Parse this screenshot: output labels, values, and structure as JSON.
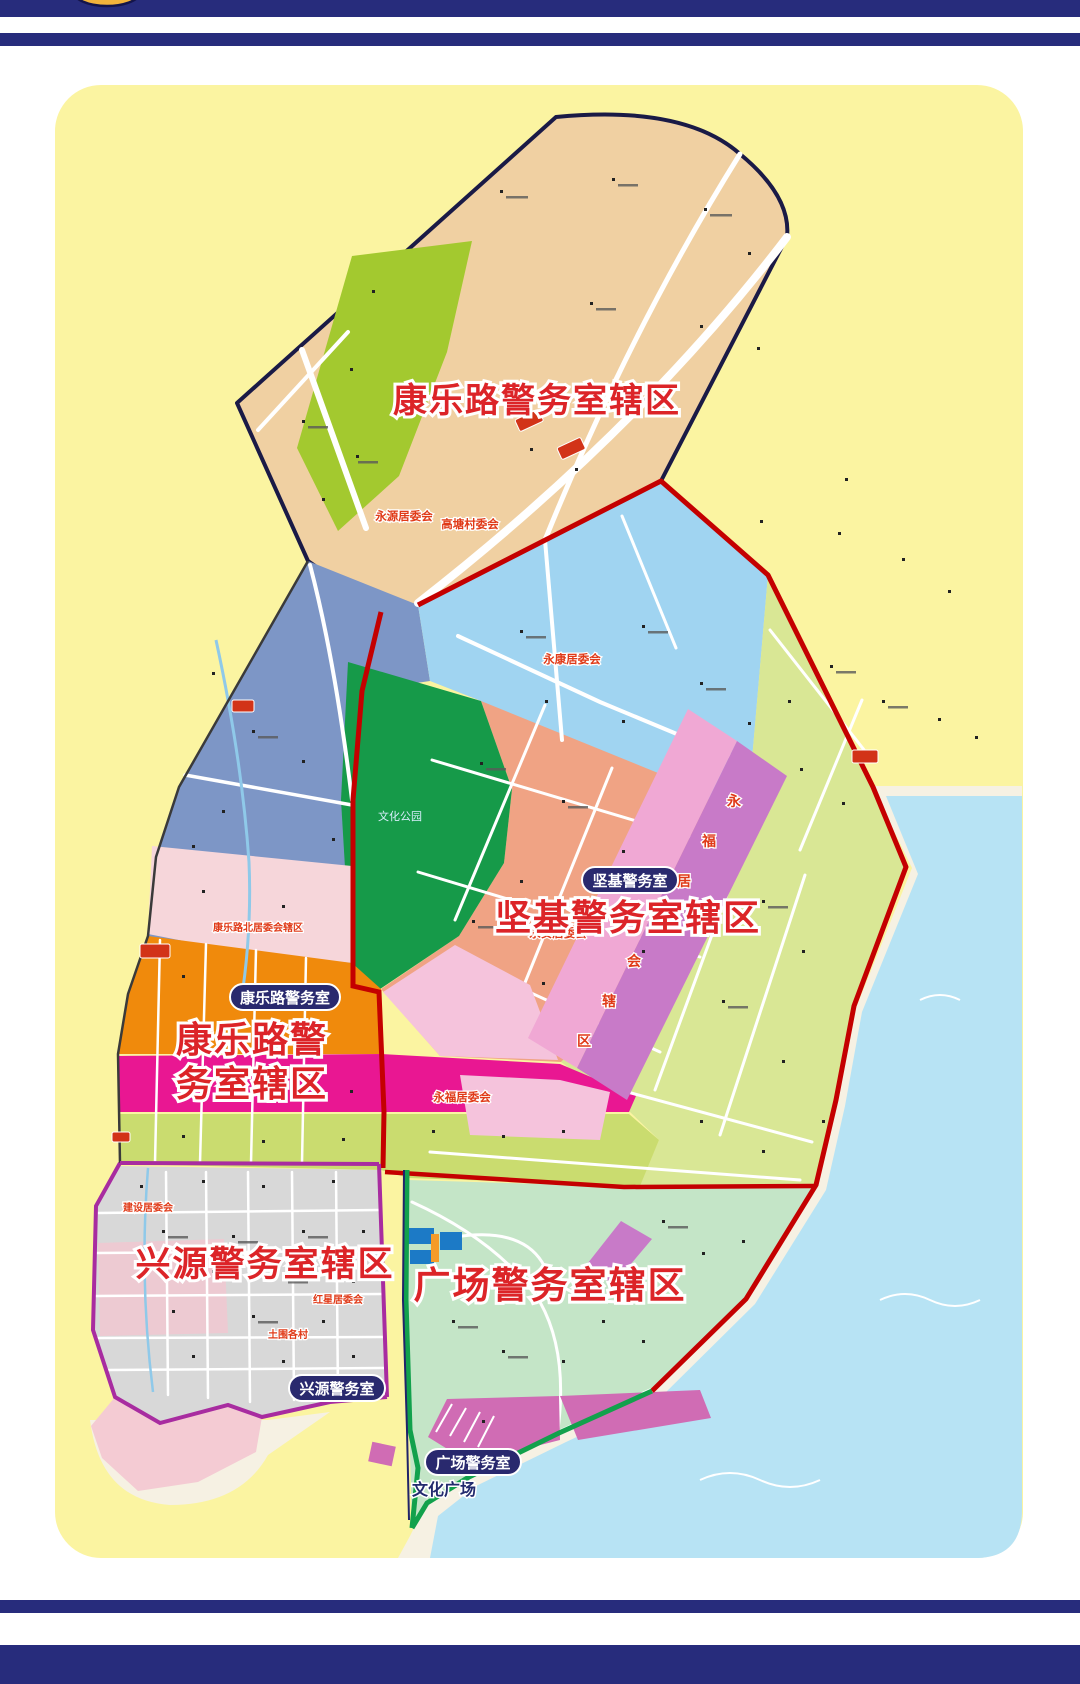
{
  "frame": {
    "emblem_icon": "police-gold-emblem"
  },
  "colors": {
    "frame_navy": "#272C7C",
    "panel_yellow": "#FBF4A1",
    "boundary_red": "#C40000",
    "boundary_purple": "#A82CA0",
    "boundary_green": "#12A14C",
    "title_red": "#DC2428",
    "badge_navy": "#29296E",
    "region_tan": "#F0D0A2",
    "region_bright_green": "#A3C92F",
    "region_slate_blue": "#7D96C6",
    "region_park_green": "#169A49",
    "region_light_blue": "#A0D4F1",
    "region_salmon": "#F0A384",
    "region_light_green": "#D9E795",
    "region_orange": "#F08A0C",
    "region_magenta": "#E91792",
    "region_yellow_green": "#CADC6F",
    "region_gray": "#D8D8D8",
    "region_pale_green": "#C4E5C7",
    "region_orchid": "#C87AC8",
    "water_blue": "#B7E3F4"
  },
  "map": {
    "region_titles": [
      {
        "id": "kanglelu-north",
        "text": "康乐路警务室辖区"
      },
      {
        "id": "jianji",
        "text": "坚基警务室辖区"
      },
      {
        "id": "kanglelu-south",
        "lines": [
          "康乐路警",
          "务室辖区"
        ]
      },
      {
        "id": "xingyuan",
        "text": "兴源警务室辖区"
      },
      {
        "id": "guangchang",
        "text": "广场警务室辖区"
      }
    ],
    "station_badges": [
      {
        "label": "坚基警务室"
      },
      {
        "label": "康乐路警务室"
      },
      {
        "label": "兴源警务室"
      },
      {
        "label": "广场警务室"
      }
    ],
    "area_labels": [
      {
        "text": "永源居委会"
      },
      {
        "text": "高塘村委会"
      },
      {
        "text": "永康居委会"
      },
      {
        "text": "康乐路北居委会辖区"
      },
      {
        "text": "永安居委会"
      },
      {
        "text": "永福居委会"
      },
      {
        "text": "建设居委会"
      },
      {
        "text": "红星居委会"
      },
      {
        "text": "土围各村"
      },
      {
        "text": "文化公园"
      },
      {
        "text": "文化广场"
      },
      {
        "text": "永福居委会辖区"
      }
    ]
  }
}
